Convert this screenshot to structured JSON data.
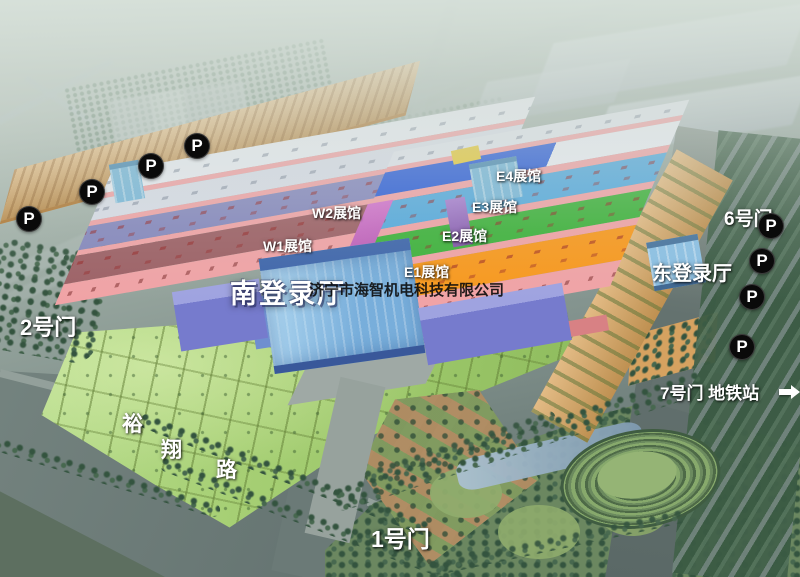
{
  "watermark": {
    "text": "济宁市海智机电科技有限公司"
  },
  "halls": {
    "w1": "W1展馆",
    "w2": "W2展馆",
    "e1": "E1展馆",
    "e2": "E2展馆",
    "e3": "E3展馆",
    "e4": "E4展馆"
  },
  "registration_halls": {
    "south": "南登录厅",
    "east": "东登录厅"
  },
  "gates": {
    "gate1": "1号门",
    "gate2": "2号门",
    "gate6": "6号门",
    "gate7_metro": "7号门 地铁站"
  },
  "road": {
    "name": "裕翔路",
    "chars": [
      "裕",
      "翔",
      "路"
    ]
  },
  "parking": {
    "label": "P",
    "count_left": 4,
    "count_right": 4
  },
  "icons": {
    "parking": "parking-icon",
    "metro_arrow": "right-arrow-icon"
  },
  "colors": {
    "e1_roof": "#f8991f",
    "e2_roof": "#3fb23c",
    "e3_roof": "#57aadd",
    "e4_roof": "#2f5fd8",
    "w1_roof": "#9d6166",
    "w2_roof": "#8688bd",
    "hall_wall_pink": "#f0a3a6",
    "registration_glass_blue": "#7db3de",
    "wing_purple": "#767bcd",
    "parking_lot_tan": "#d9a45c",
    "lawn_green": "#a6cf74",
    "road_grey": "#687673",
    "park_green": "#648058",
    "marker_black": "#0a0a0a",
    "label_white": "#ffffff"
  }
}
